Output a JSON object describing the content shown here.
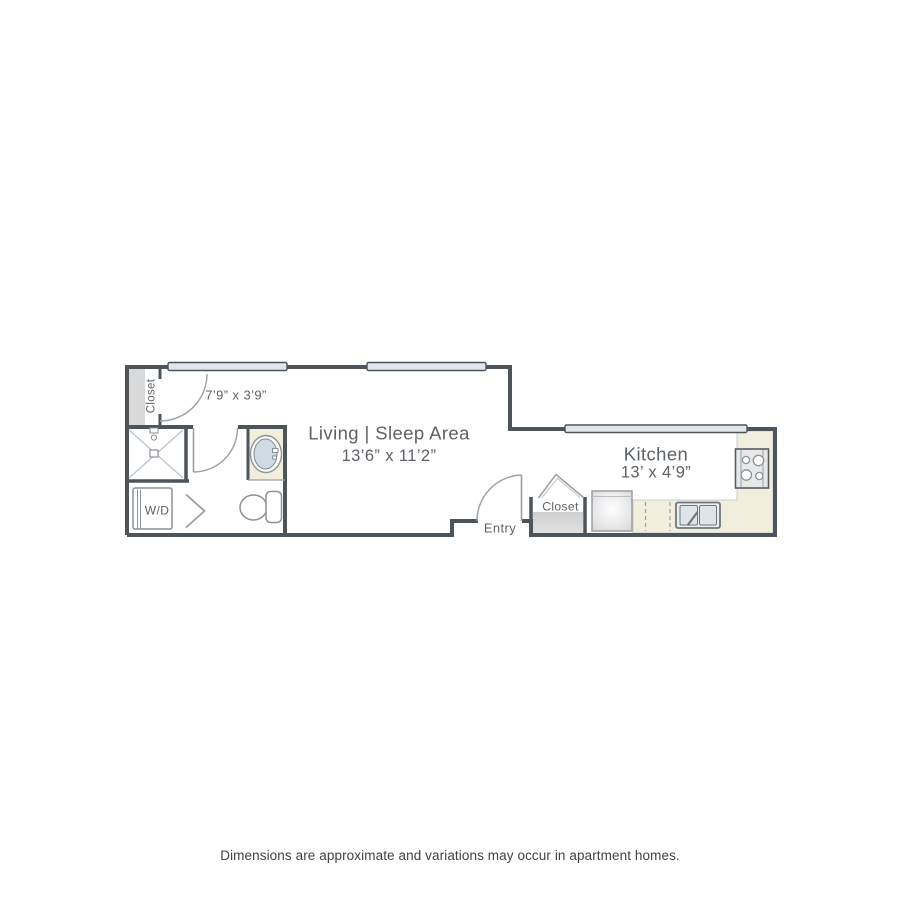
{
  "floorplan": {
    "living_area": {
      "name": "Living | Sleep Area",
      "dimensions": "13’6” x 11’2”"
    },
    "kitchen": {
      "name": "Kitchen",
      "dimensions": "13’ x 4’9”"
    },
    "bathroom": {
      "dimensions": "7’9” x 3’9”"
    },
    "closet_left": {
      "label": "Closet"
    },
    "entry_closet": {
      "label": "Closet"
    },
    "entry": {
      "label": "Entry"
    },
    "washer_dryer": {
      "label": "W/D"
    }
  },
  "disclaimer": "Dimensions are approximate and variations may occur in apartment homes.",
  "colors": {
    "wall": "#4d545a",
    "fixture_outline": "#8b9298",
    "counter_fill": "#f2eedd",
    "closet_shelf_fill": "#d9d9d9",
    "window_fill": "#dfe6ec",
    "label_text": "#5d6267",
    "disclaimer_text": "#3f4347",
    "background": "#ffffff"
  }
}
